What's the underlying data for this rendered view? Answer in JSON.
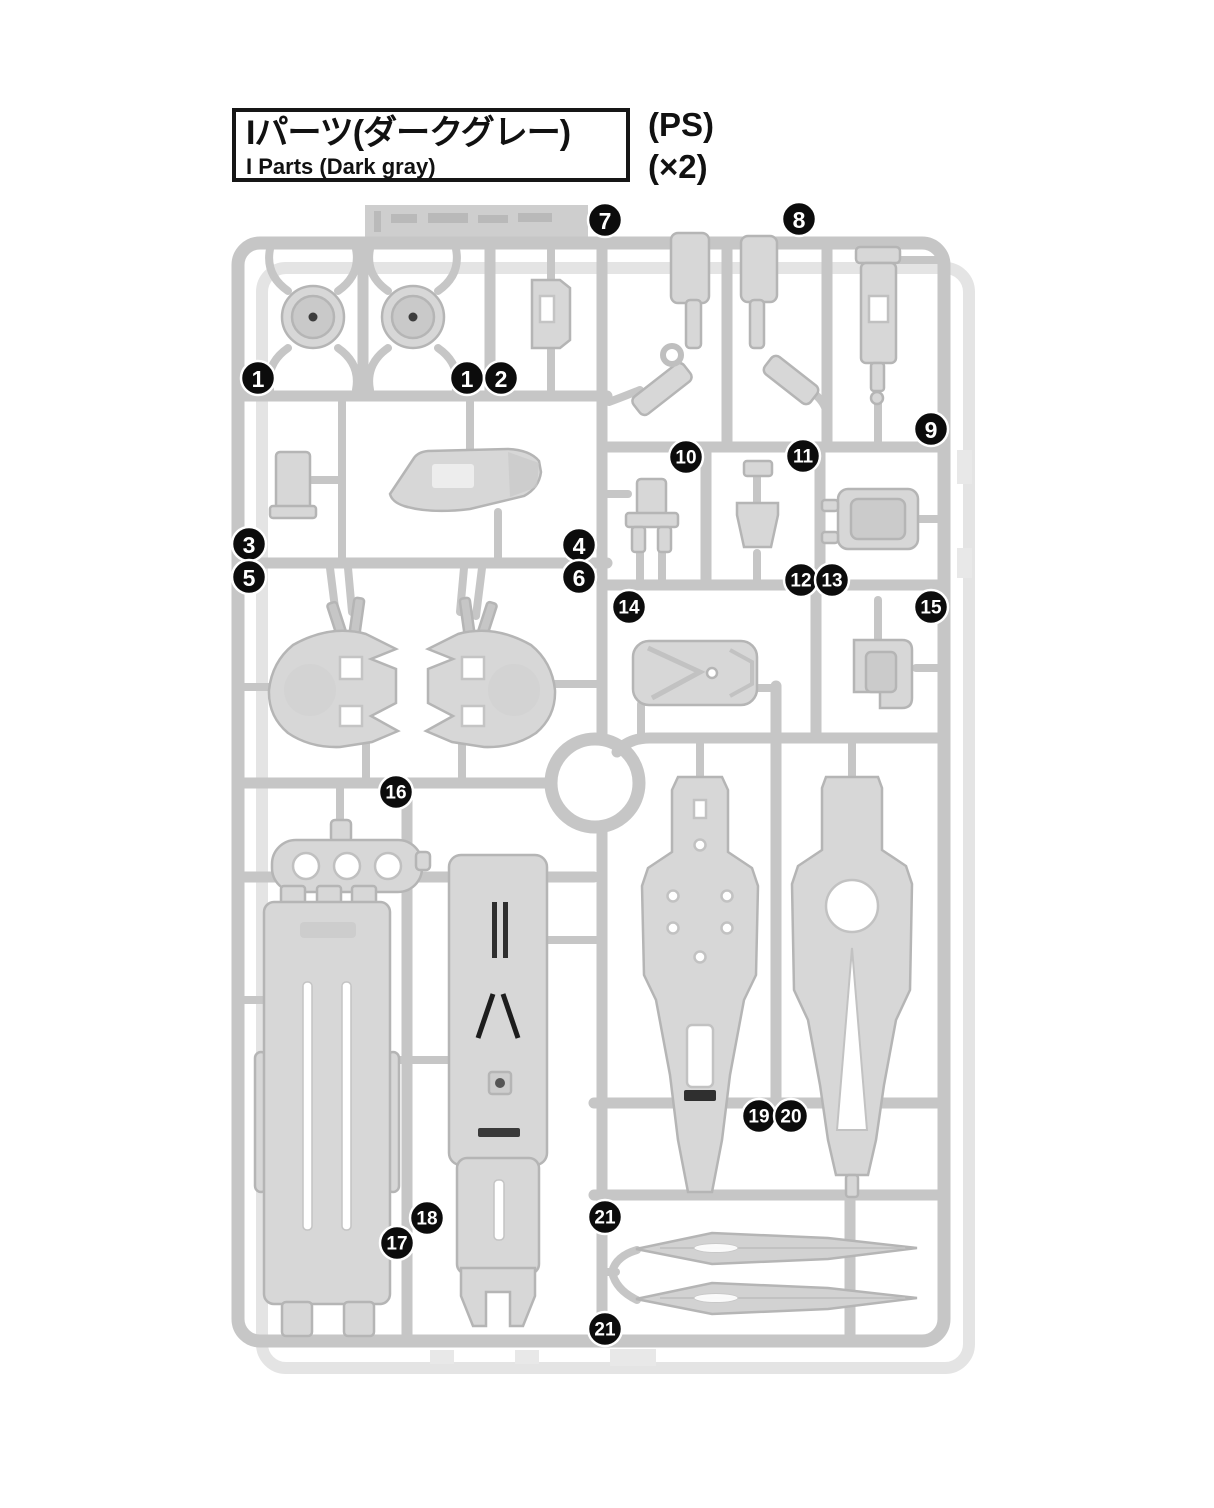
{
  "header": {
    "title_jp": "Iパーツ(ダークグレー)",
    "title_en": "I Parts (Dark gray)",
    "material": "(PS)",
    "quantity": "(×2)"
  },
  "diagram": {
    "kind": "model-kit runner (sprue) part-location diagram",
    "colors": {
      "rail": "#c6c6c6",
      "ghost": "#e4e4e4",
      "part_fill": "#d7d7d7",
      "part_stroke": "#b5b5b5",
      "part_inner": "#cbcbcb",
      "detail_dark": "#2e2e2e",
      "callout_bg": "#0c0c0c",
      "callout_fg": "#ffffff"
    },
    "callouts": [
      {
        "label": "1",
        "x": 258,
        "y": 378
      },
      {
        "label": "1",
        "x": 467,
        "y": 378
      },
      {
        "label": "2",
        "x": 501,
        "y": 378
      },
      {
        "label": "7",
        "x": 605,
        "y": 220
      },
      {
        "label": "8",
        "x": 799,
        "y": 219
      },
      {
        "label": "9",
        "x": 931,
        "y": 429
      },
      {
        "label": "3",
        "x": 249,
        "y": 544
      },
      {
        "label": "5",
        "x": 249,
        "y": 577
      },
      {
        "label": "4",
        "x": 579,
        "y": 545
      },
      {
        "label": "6",
        "x": 579,
        "y": 577
      },
      {
        "label": "10",
        "x": 686,
        "y": 457
      },
      {
        "label": "11",
        "x": 803,
        "y": 456
      },
      {
        "label": "12",
        "x": 801,
        "y": 580
      },
      {
        "label": "13",
        "x": 832,
        "y": 580
      },
      {
        "label": "14",
        "x": 629,
        "y": 607
      },
      {
        "label": "15",
        "x": 931,
        "y": 607
      },
      {
        "label": "16",
        "x": 396,
        "y": 792
      },
      {
        "label": "18",
        "x": 427,
        "y": 1218
      },
      {
        "label": "17",
        "x": 397,
        "y": 1243
      },
      {
        "label": "19",
        "x": 759,
        "y": 1116
      },
      {
        "label": "20",
        "x": 791,
        "y": 1116
      },
      {
        "label": "21",
        "x": 605,
        "y": 1217
      },
      {
        "label": "21",
        "x": 605,
        "y": 1329
      }
    ]
  }
}
